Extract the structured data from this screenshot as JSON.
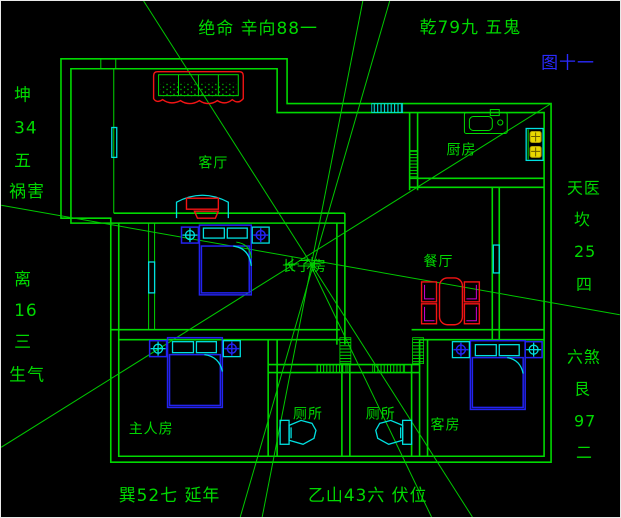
{
  "figure": {
    "label": "图十一",
    "color": "#2a2aff"
  },
  "compass": {
    "top_left": "绝命 辛向88一",
    "top_right": "乾79九 五鬼",
    "left": [
      "坤",
      "34",
      "五",
      "祸害",
      "离",
      "16",
      "三",
      "生气"
    ],
    "right": [
      "天医",
      "坎",
      "25",
      "四",
      "六煞",
      "艮",
      "97",
      "二"
    ],
    "bottom_left": "巽52七 延年",
    "bottom_right": "乙山43六 伏位"
  },
  "rooms": {
    "living": "客厅",
    "kitchen": "厨房",
    "dining": "餐厅",
    "eldest_son": "长子房",
    "master": "主人房",
    "toilet1": "厕所",
    "toilet2": "厕所",
    "guest": "客房"
  },
  "colors": {
    "background": "#000000",
    "line_green": "#00d900",
    "furniture_red": "#f21414",
    "accent_cyan": "#00e0e0",
    "accent_blue": "#2323f0",
    "figure_blue": "#2a2aff",
    "burner_yellow": "#e8d800",
    "chair_magenta": "#d400d4"
  }
}
